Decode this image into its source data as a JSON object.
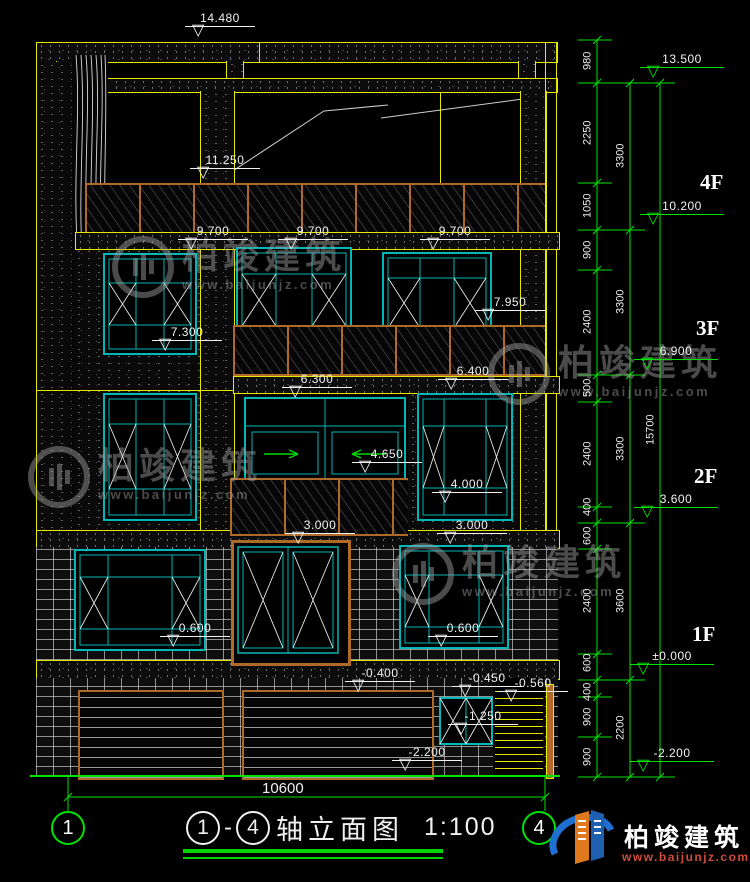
{
  "markers": {
    "m14480": "14.480",
    "m11250": "11.250",
    "m9700a": "9.700",
    "m9700b": "9.700",
    "m9700c": "9.700",
    "m7950": "7.950",
    "m7300": "7.300",
    "m6300": "6.300",
    "m6400": "6.400",
    "m4650": "4.650",
    "m4000": "4.000",
    "m3000a": "3.000",
    "m3000b": "3.000",
    "m0600a": "0.600",
    "m0600b": "0.600",
    "mneg0400": "-0.400",
    "mneg0450": "-0.450",
    "mneg0560": "-0.560",
    "mneg1250": "-1.250",
    "mneg2200": "-2.200"
  },
  "right_panel": {
    "levels": {
      "l13500": "13.500",
      "l10200": "10.200",
      "l6900": "6.900",
      "l3600": "3.600",
      "l0": "±0.000",
      "lneg2200": "-2.200"
    },
    "floors": {
      "f4": "4F",
      "f3": "3F",
      "f2": "2F",
      "f1": "1F"
    },
    "inner_dims": [
      "980",
      "2250",
      "1050",
      "900",
      "2400",
      "500",
      "2400",
      "400",
      "600",
      "2400",
      "600",
      "400",
      "900",
      "900"
    ],
    "middle_dims": [
      "3300",
      "3300",
      "3300",
      "3600",
      "2200"
    ],
    "total_dim": "15700"
  },
  "bottom": {
    "width_dim": "10600",
    "axis_left": "1",
    "axis_right": "4"
  },
  "title": {
    "axis_left": "1",
    "dash": "-",
    "axis_right": "4",
    "name": "轴立面图",
    "scale": "1:100"
  },
  "branding": {
    "watermark_cn": "柏竣建筑",
    "watermark_url": "www.baijunjz.com",
    "logo_cn": "柏竣建筑",
    "logo_url": "www.baijunjz.com"
  }
}
